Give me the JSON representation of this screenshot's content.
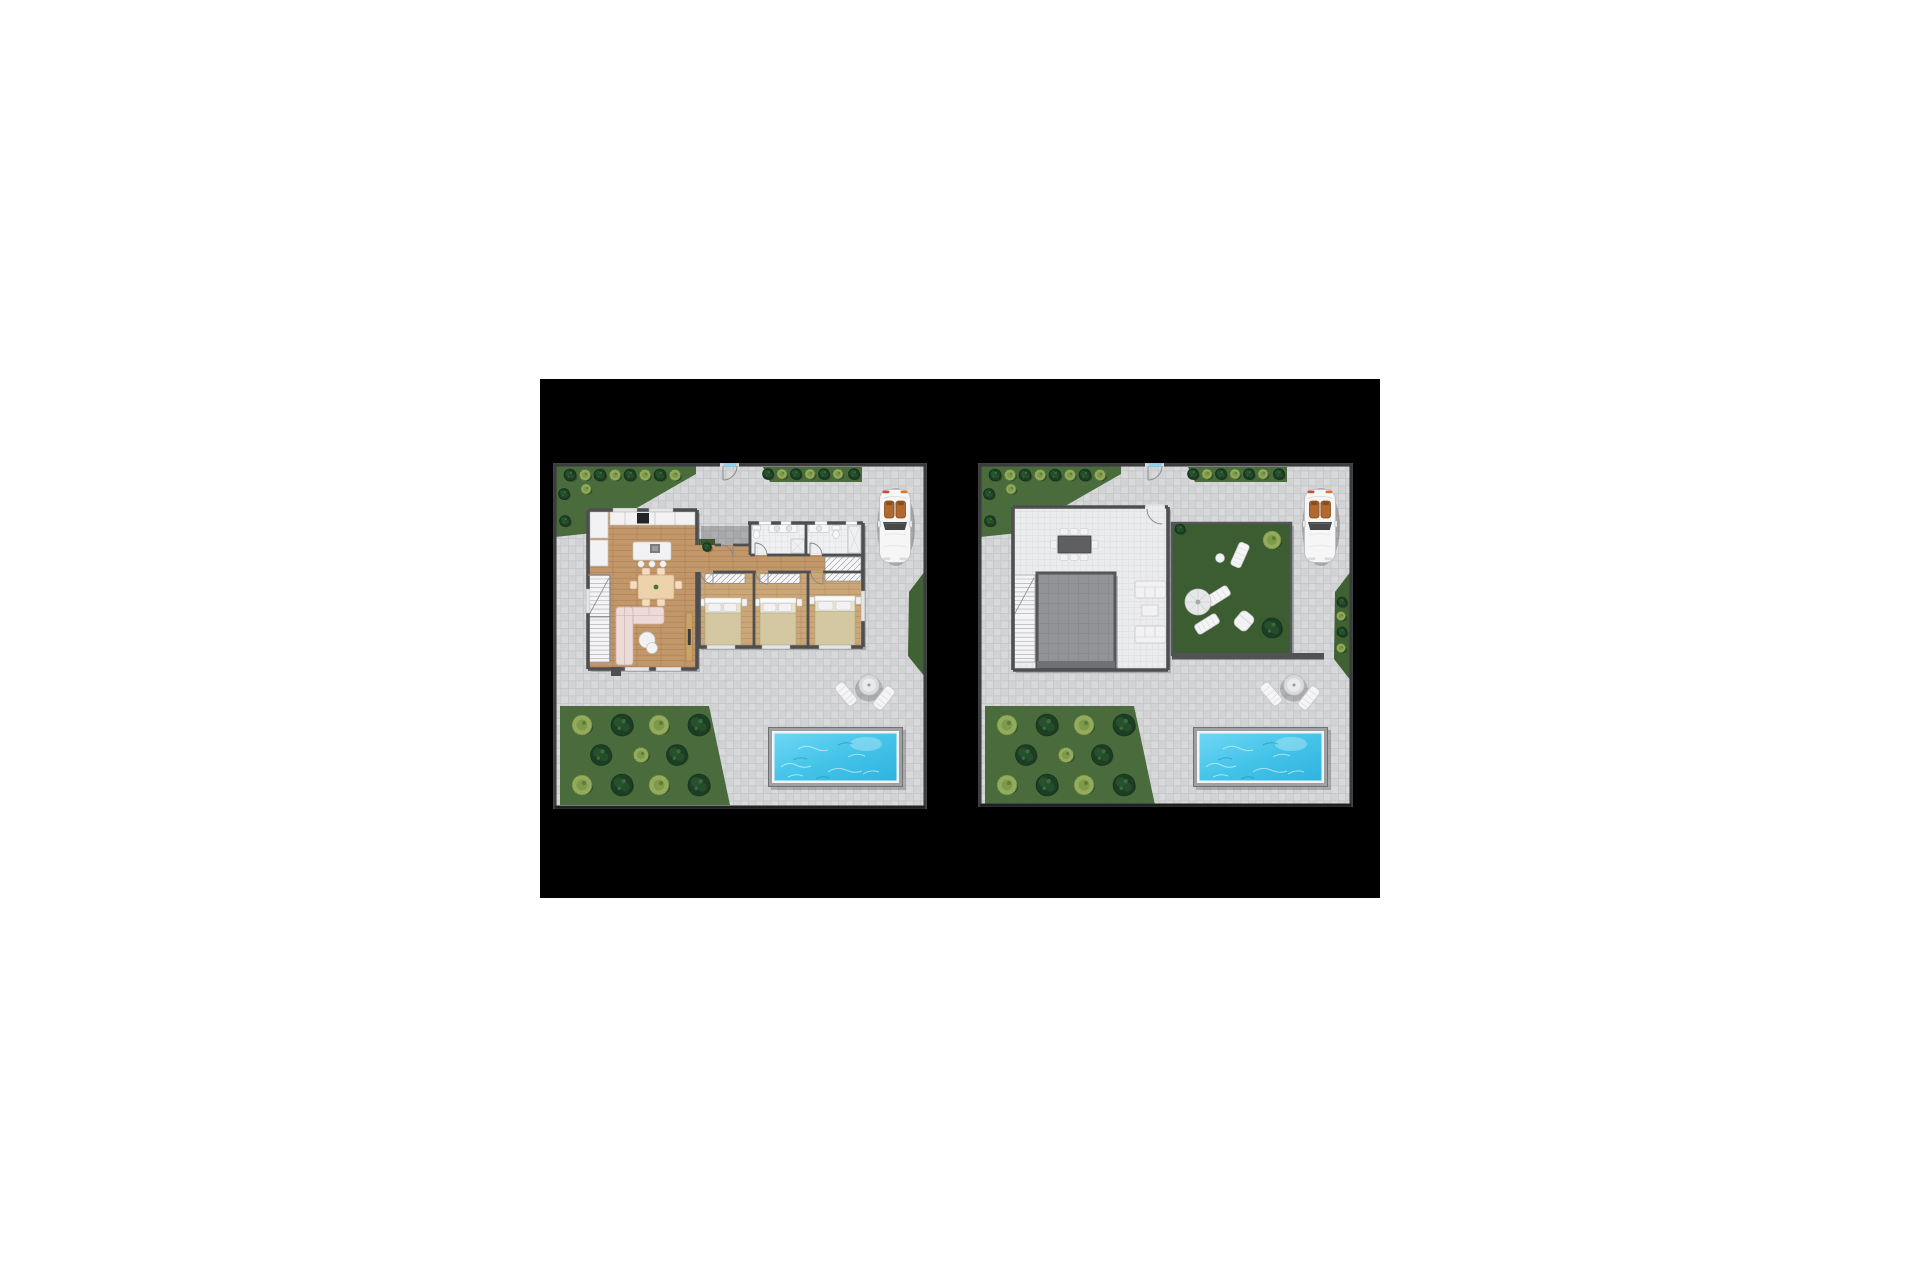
{
  "scene": {
    "page_bg": "#ffffff",
    "matte_bg": "#000000",
    "description": "two-villa-floor-plans",
    "left_plan": "ground-floor-plan",
    "right_plan": "roof-terrace-plan"
  },
  "palette": {
    "pageBg": "#ffffff",
    "matteBg": "#000000",
    "paving": "#d2d3d5",
    "paving2": "#d8d9db",
    "pavingLine": "#c3c4c6",
    "deck": "#ebecee",
    "deckLine": "#dddee0",
    "wall": "#4e4f52",
    "wallThin": "#88898b",
    "siteBorder": "#3b3c3e",
    "wood": "#c2976a",
    "woodLine": "#ab8051",
    "wood2": "#cba678",
    "wood2Line": "#b38d5c",
    "bath": "#eef0f2",
    "bathLine": "#dcdee0",
    "hatchBg": "#f6f6f8",
    "hatchLine": "#8f9093",
    "grass": "#4a6b3c",
    "roofGrass": "#3c5c31",
    "hedge": "#3f6134",
    "treeDark": "#1c3f24",
    "treeDark2": "#27512c",
    "treeDarkEdge": "#122917",
    "treeDot": "#3a6b3f",
    "bushLight": "#93ab5c",
    "bushLight2": "#7d9a4a",
    "bushEdge": "#5f7c36",
    "poolFrame": "#9fa0a2",
    "poolRim": "#f2f3f5",
    "water1": "#6ed7f4",
    "water2": "#2fb3de",
    "white1": "#f2f2f4",
    "stroke1": "#c6c7c9",
    "sofa": "#ecdbd8",
    "sofaEdge": "#c9aeab",
    "tanWood": "#edd2ae",
    "tanEdge": "#cfa878",
    "blanket": "#d3c8a2",
    "blanketEdge": "#b3a67e",
    "graySq": "#929396",
    "graySqLine": "#85868a",
    "carSeat": "#b06a30",
    "carSeatDark": "#8a4e1d",
    "glass": "#8fd4ec",
    "doorArc": "#85868a"
  },
  "plans": {
    "ground_floor": {
      "name": "ground-floor-plan",
      "features": [
        "kitchen",
        "living-dining-room",
        "bedroom-1",
        "bedroom-2",
        "master-bedroom",
        "bathroom-1",
        "bathroom-2",
        "staircase",
        "entrance",
        "parked-car",
        "patio-table-with-loungers",
        "swimming-pool",
        "garden-with-trees"
      ],
      "trees": [
        [
          "d",
          17,
          12,
          6
        ],
        [
          "l",
          32,
          12,
          5.5
        ],
        [
          "d",
          47,
          12,
          6
        ],
        [
          "l",
          62,
          12,
          5.5
        ],
        [
          "d",
          77,
          12,
          6
        ],
        [
          "l",
          92,
          12,
          5.5
        ],
        [
          "d",
          107,
          12,
          6
        ],
        [
          "l",
          122,
          12,
          5.5
        ],
        [
          "l",
          33,
          26,
          5
        ],
        [
          "d",
          11,
          31,
          5.5
        ],
        [
          "d",
          12,
          58,
          5.5
        ],
        [
          "d",
          215,
          11,
          5.5
        ],
        [
          "l",
          229,
          11,
          5
        ],
        [
          "d",
          243,
          11,
          5.5
        ],
        [
          "l",
          257,
          11,
          5
        ],
        [
          "d",
          271,
          11,
          5.5
        ],
        [
          "l",
          285,
          11,
          5
        ],
        [
          "d",
          301,
          11,
          5.5
        ],
        [
          "d",
          154,
          84,
          4.5
        ],
        [
          "l",
          29,
          262,
          10
        ],
        [
          "d",
          69,
          262,
          11
        ],
        [
          "l",
          106,
          262,
          10
        ],
        [
          "d",
          146,
          262,
          11
        ],
        [
          "d",
          48,
          292,
          10.5
        ],
        [
          "l",
          88,
          292,
          7.5
        ],
        [
          "d",
          124,
          292,
          10.5
        ],
        [
          "l",
          29,
          322,
          10
        ],
        [
          "d",
          69,
          322,
          11
        ],
        [
          "l",
          106,
          322,
          10
        ],
        [
          "d",
          146,
          322,
          11
        ]
      ]
    },
    "roof_terrace": {
      "name": "roof-terrace-plan",
      "features": [
        "roof-deck",
        "outdoor-dining-table",
        "lounge-sofas",
        "skylight-deck",
        "staircase",
        "green-roof-garden",
        "sun-loungers",
        "parasol",
        "parked-car",
        "patio-table-with-loungers",
        "swimming-pool",
        "garden-with-trees"
      ],
      "trees": [
        [
          "d",
          17,
          12,
          6
        ],
        [
          "l",
          32,
          12,
          5.5
        ],
        [
          "d",
          47,
          12,
          6
        ],
        [
          "l",
          62,
          12,
          5.5
        ],
        [
          "d",
          77,
          12,
          6
        ],
        [
          "l",
          92,
          12,
          5.5
        ],
        [
          "d",
          107,
          12,
          6
        ],
        [
          "l",
          122,
          12,
          5.5
        ],
        [
          "l",
          33,
          26,
          5
        ],
        [
          "d",
          11,
          31,
          5.5
        ],
        [
          "d",
          12,
          58,
          5.5
        ],
        [
          "d",
          215,
          11,
          5.5
        ],
        [
          "l",
          229,
          11,
          5
        ],
        [
          "d",
          243,
          11,
          5.5
        ],
        [
          "l",
          257,
          11,
          5
        ],
        [
          "d",
          271,
          11,
          5.5
        ],
        [
          "l",
          285,
          11,
          5
        ],
        [
          "d",
          301,
          11,
          5.5
        ],
        [
          "d",
          364,
          139,
          5
        ],
        [
          "l",
          363,
          153,
          4.5
        ],
        [
          "d",
          364,
          169,
          5
        ],
        [
          "l",
          363,
          185,
          4.5
        ],
        [
          "d",
          202,
          66,
          5
        ],
        [
          "l",
          294,
          77,
          9
        ],
        [
          "d",
          294,
          165,
          10
        ],
        [
          "l",
          29,
          262,
          10
        ],
        [
          "d",
          69,
          262,
          11
        ],
        [
          "l",
          106,
          262,
          10
        ],
        [
          "d",
          146,
          262,
          11
        ],
        [
          "d",
          48,
          292,
          10.5
        ],
        [
          "l",
          88,
          292,
          7.5
        ],
        [
          "d",
          124,
          292,
          10.5
        ],
        [
          "l",
          29,
          322,
          10
        ],
        [
          "d",
          69,
          322,
          11
        ],
        [
          "l",
          106,
          322,
          10
        ],
        [
          "d",
          146,
          322,
          11
        ]
      ]
    }
  }
}
